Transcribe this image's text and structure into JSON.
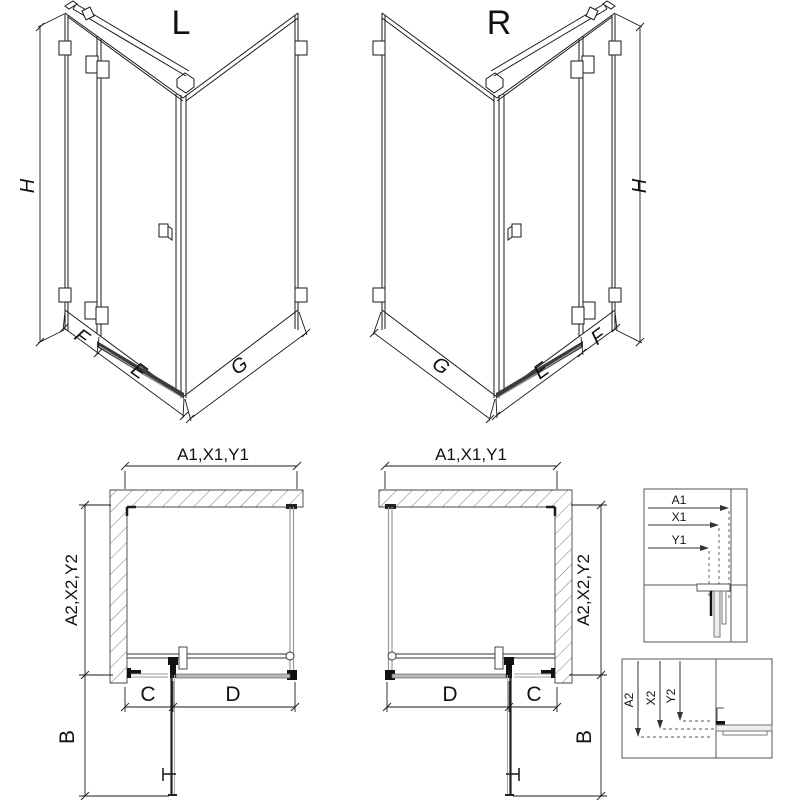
{
  "drawing": {
    "iso_left": {
      "title": "L",
      "height_dim": "H",
      "fixed_dim": "F",
      "door_dim": "E",
      "side_dim": "G"
    },
    "iso_right": {
      "title": "R",
      "height_dim": "H",
      "fixed_dim": "F",
      "door_dim": "E",
      "side_dim": "G"
    },
    "plan_left": {
      "top_dim": "A1,X1,Y1",
      "side_dim": "A2,X2,Y2",
      "c_dim": "C",
      "d_dim": "D",
      "b_dim": "B"
    },
    "plan_right": {
      "top_dim": "A1,X1,Y1",
      "side_dim": "A2,X2,Y2",
      "c_dim": "C",
      "d_dim": "D",
      "b_dim": "B"
    },
    "detail_top": {
      "dims": [
        "A1",
        "X1",
        "Y1"
      ]
    },
    "detail_bottom": {
      "dims": [
        "A2",
        "X2",
        "Y2"
      ]
    },
    "colors": {
      "line": "#1a1a1a",
      "glass": "#999999",
      "threshold": "#3c3c3c",
      "background": "#ffffff"
    }
  }
}
